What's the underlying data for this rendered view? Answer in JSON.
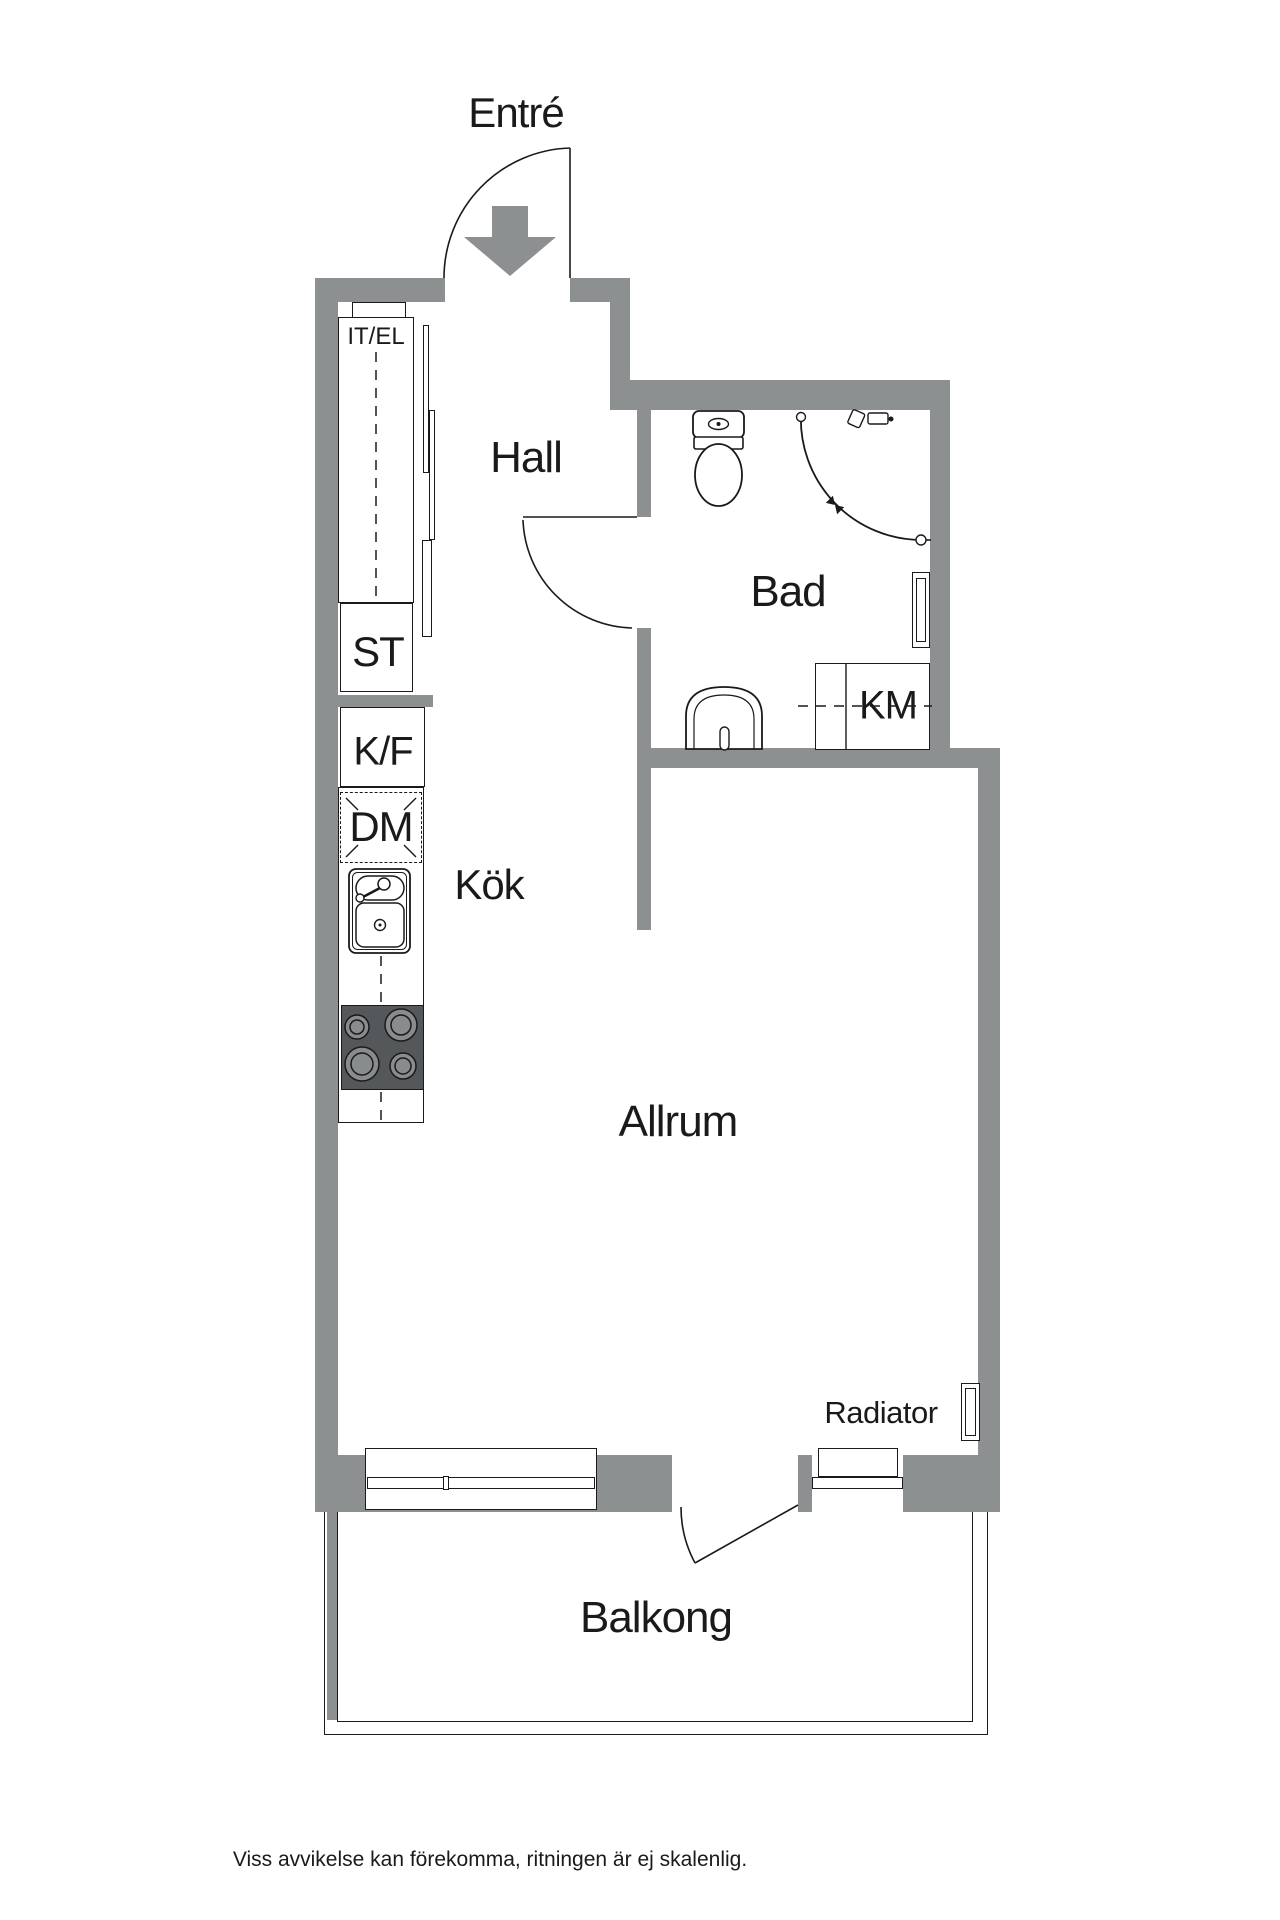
{
  "plan": {
    "title": "Apartment floor plan",
    "rooms": {
      "entre": {
        "label": "Entré"
      },
      "hall": {
        "label": "Hall"
      },
      "bad": {
        "label": "Bad"
      },
      "kok": {
        "label": "Kök"
      },
      "allrum": {
        "label": "Allrum"
      },
      "balkong": {
        "label": "Balkong"
      }
    },
    "fixtures": {
      "it_el": {
        "label": "IT/EL"
      },
      "st": {
        "label": "ST"
      },
      "kf": {
        "label": "K/F"
      },
      "dm": {
        "label": "DM"
      },
      "km": {
        "label": "KM"
      },
      "radiator": {
        "label": "Radiator"
      }
    },
    "disclaimer": "Viss avvikelse kan förekomma, ritningen är ej skalenlig.",
    "colors": {
      "wall": "#8D9091",
      "stove_base": "#54585A",
      "burner": "#898C8D",
      "line": "#1A1A1A",
      "background": "#FFFFFF"
    }
  }
}
